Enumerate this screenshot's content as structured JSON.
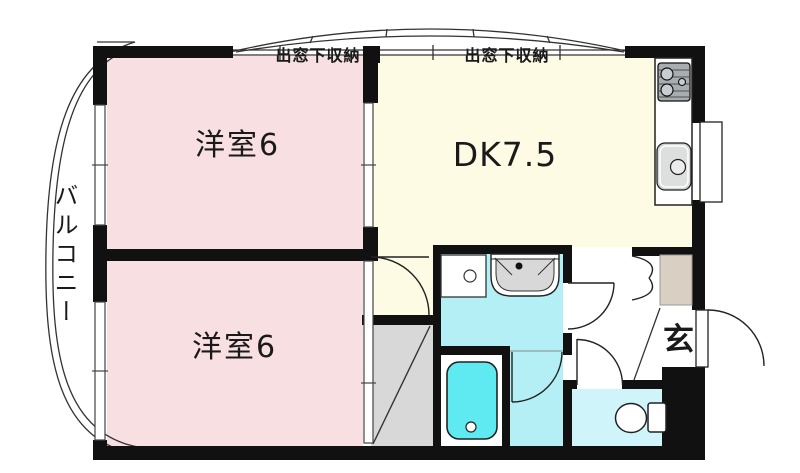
{
  "plan": {
    "rooms": [
      {
        "id": "bedroom-top",
        "label": "洋室6",
        "floor_color": "#f8dfe2"
      },
      {
        "id": "dining-kitchen",
        "label": "DK7.5",
        "floor_color": "#fdfbe4"
      },
      {
        "id": "bedroom-bottom",
        "label": "洋室6",
        "floor_color": "#f8dfe2"
      },
      {
        "id": "entrance",
        "label": "玄",
        "floor_color": "#ffffff"
      },
      {
        "id": "balcony",
        "label": "バルコニー",
        "floor_color": "#ffffff"
      }
    ],
    "annotations": [
      {
        "id": "bay-storage-left",
        "label": "出窓下収納"
      },
      {
        "id": "bay-storage-right",
        "label": "出窓下収納"
      }
    ],
    "fixtures": [
      "gas-stove",
      "kitchen-sink",
      "water-heater",
      "washing-machine-pan",
      "washbasin",
      "bathtub",
      "toilet",
      "shoe-cabinet",
      "closet"
    ],
    "colors": {
      "wall": "#111111",
      "bedroom_pink": "#f8dfe2",
      "dk_cream": "#fdfbe4",
      "washroom_cyan": "#b5eff6",
      "toilet_cyan": "#cff5fa",
      "bathtub_cyan": "#5fe9f0",
      "closet_gray": "#d8d8d8",
      "shoe_cabinet_beige": "#d9cfc3"
    }
  }
}
